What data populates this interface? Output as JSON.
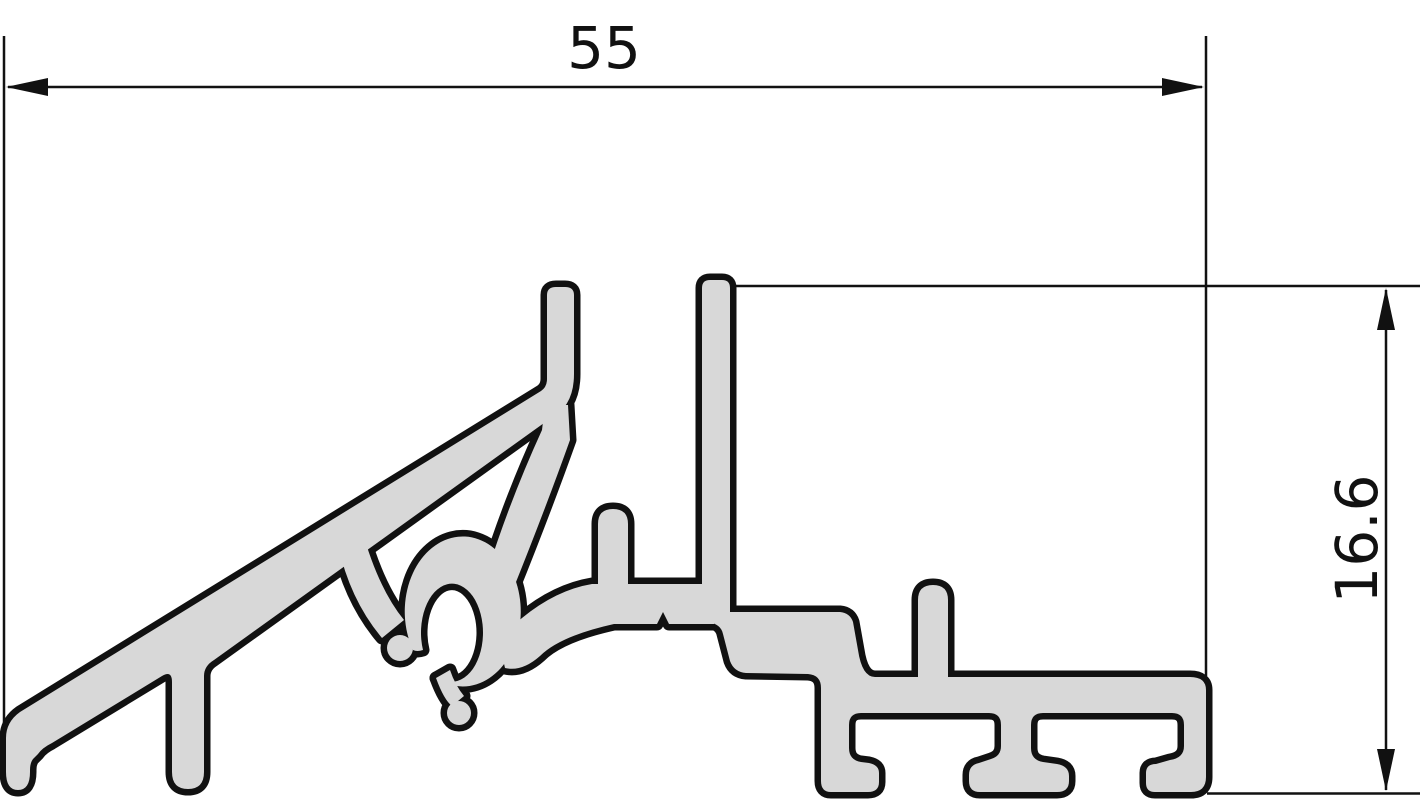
{
  "drawing": {
    "title": "Aluminium sill profile cross-section",
    "type": "technical dimension drawing"
  },
  "dimensions": {
    "width": {
      "label": "55"
    },
    "height": {
      "label": "16.6"
    }
  },
  "colors": {
    "profile_fill": "#d8d8d8",
    "outline": "#111111",
    "background": "#ffffff"
  }
}
